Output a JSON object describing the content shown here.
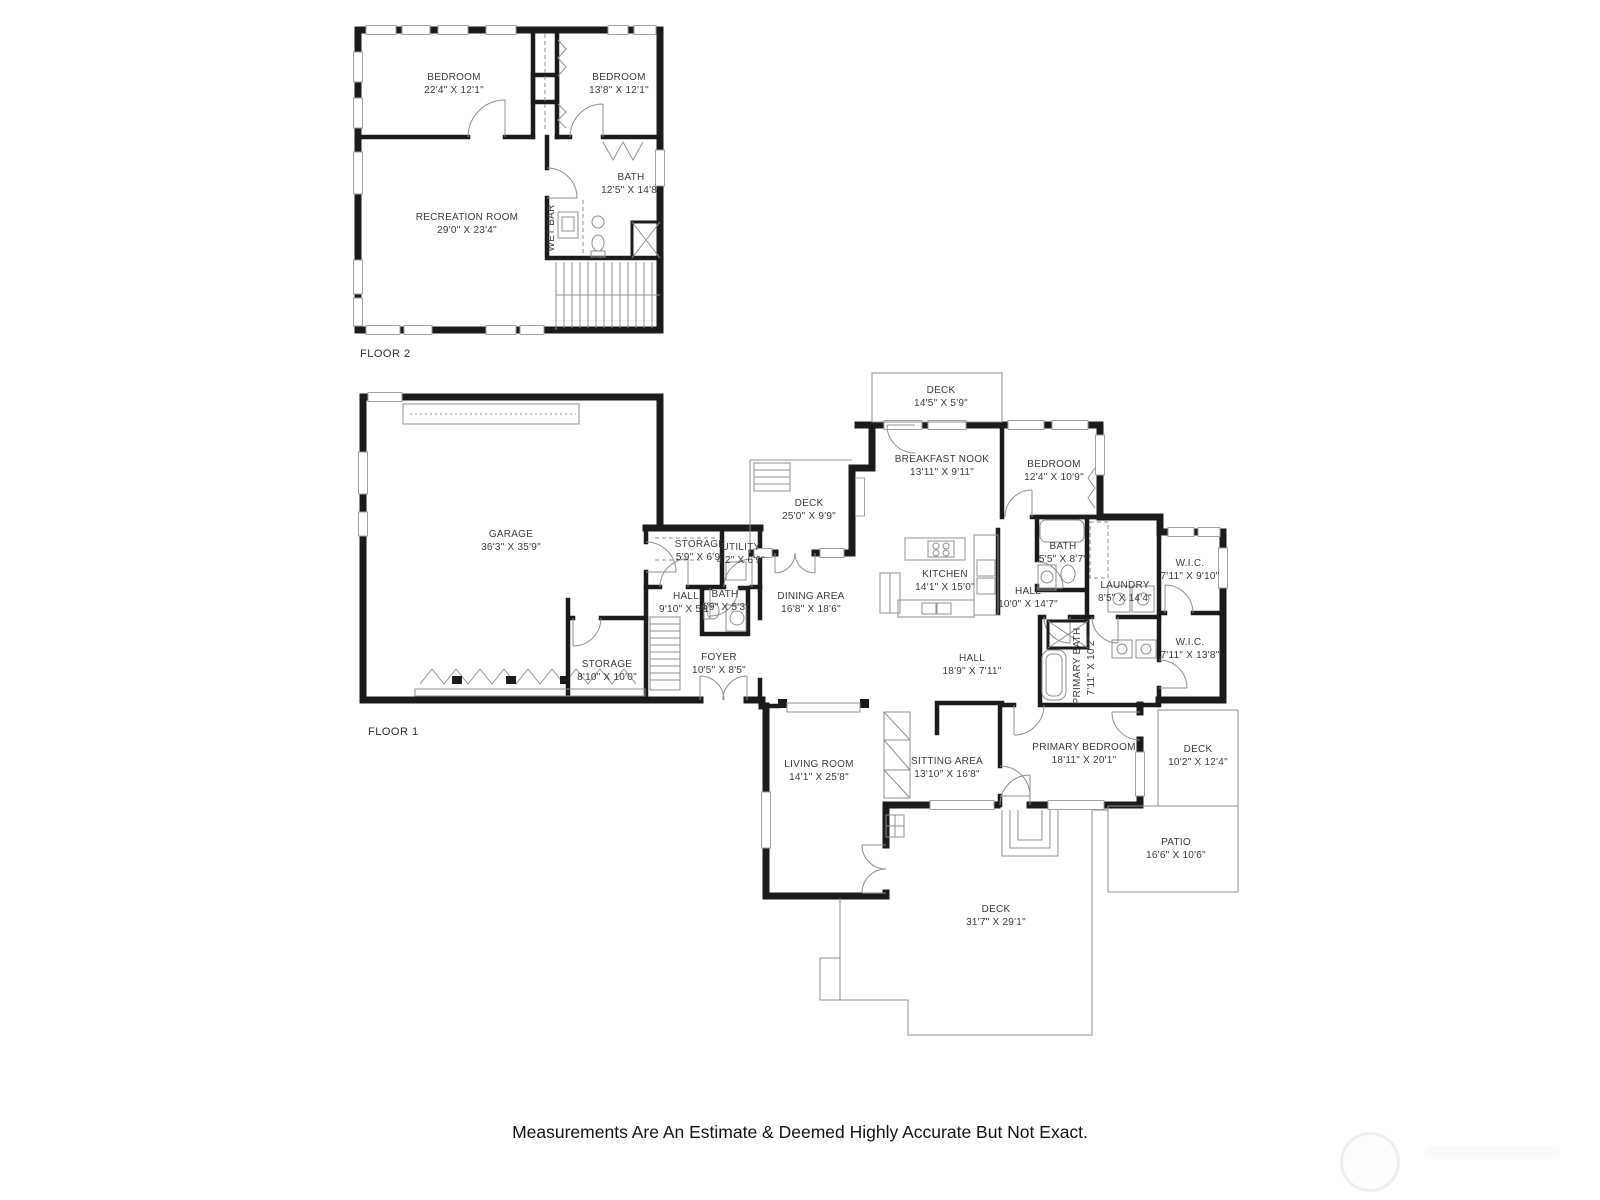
{
  "page": {
    "disclaimer": "Measurements Are An Estimate & Deemed Highly Accurate But Not Exact."
  },
  "floor2": {
    "label": "FLOOR 2",
    "rooms": {
      "bedroom_large": {
        "name": "BEDROOM",
        "dims": "22'4\" X 12'1\""
      },
      "bedroom_small": {
        "name": "BEDROOM",
        "dims": "13'8\" X 12'1\""
      },
      "bath": {
        "name": "BATH",
        "dims": "12'5\" X 14'8\""
      },
      "recreation": {
        "name": "RECREATION ROOM",
        "dims": "29'0\" X 23'4\""
      },
      "wet_bar": {
        "name": "WET BAR"
      }
    }
  },
  "floor1": {
    "label": "FLOOR 1",
    "rooms": {
      "deck_top": {
        "name": "DECK",
        "dims": "14'5\" X 5'9\""
      },
      "breakfast_nook": {
        "name": "BREAKFAST NOOK",
        "dims": "13'11\" X 9'11\""
      },
      "bedroom": {
        "name": "BEDROOM",
        "dims": "12'4\" X 10'9\""
      },
      "deck_mid": {
        "name": "DECK",
        "dims": "25'0\" X 9'9\""
      },
      "garage": {
        "name": "GARAGE",
        "dims": "36'3\" X 35'9\""
      },
      "storage_small": {
        "name": "STORAGE",
        "dims": "5'9\" X 6'9\""
      },
      "utility": {
        "name": "UTILITY",
        "dims": "4'2\" X 6'9\""
      },
      "kitchen": {
        "name": "KITCHEN",
        "dims": "14'1\" X 15'0\""
      },
      "bath_hall": {
        "name": "BATH",
        "dims": "5'5\" X 8'7\""
      },
      "wic_top": {
        "name": "W.I.C.",
        "dims": "7'11\" X 9'10\""
      },
      "hall_small": {
        "name": "HALL",
        "dims": "9'10\" X 5'1\""
      },
      "bath_powder": {
        "name": "BATH",
        "dims": "4'9\" X 5'3\""
      },
      "dining": {
        "name": "DINING AREA",
        "dims": "16'8\" X 18'6\""
      },
      "hall_mid": {
        "name": "HALL",
        "dims": "10'0\" X 14'7\""
      },
      "laundry": {
        "name": "LAUNDRY",
        "dims": "8'5\" X 14'4\""
      },
      "wic_bottom": {
        "name": "W.I.C.",
        "dims": "7'11\" X 13'8\""
      },
      "storage_garage": {
        "name": "STORAGE",
        "dims": "8'10\" X 10'0\""
      },
      "foyer": {
        "name": "FOYER",
        "dims": "10'5\" X 8'5\""
      },
      "hall_large": {
        "name": "HALL",
        "dims": "18'9\" X 7'11\""
      },
      "primary_bath": {
        "name": "PRIMARY BATH",
        "dims": "7'11\" X 10'2\""
      },
      "primary_bedroom": {
        "name": "PRIMARY BEDROOM",
        "dims": "18'11\" X 20'1\""
      },
      "deck_right": {
        "name": "DECK",
        "dims": "10'2\" X 12'4\""
      },
      "living": {
        "name": "LIVING ROOM",
        "dims": "14'1\" X 25'8\""
      },
      "sitting": {
        "name": "SITTING AREA",
        "dims": "13'10\" X 16'8\""
      },
      "patio": {
        "name": "PATIO",
        "dims": "16'6\" X 10'6\""
      },
      "deck_large": {
        "name": "DECK",
        "dims": "31'7\" X 29'1\""
      }
    }
  }
}
